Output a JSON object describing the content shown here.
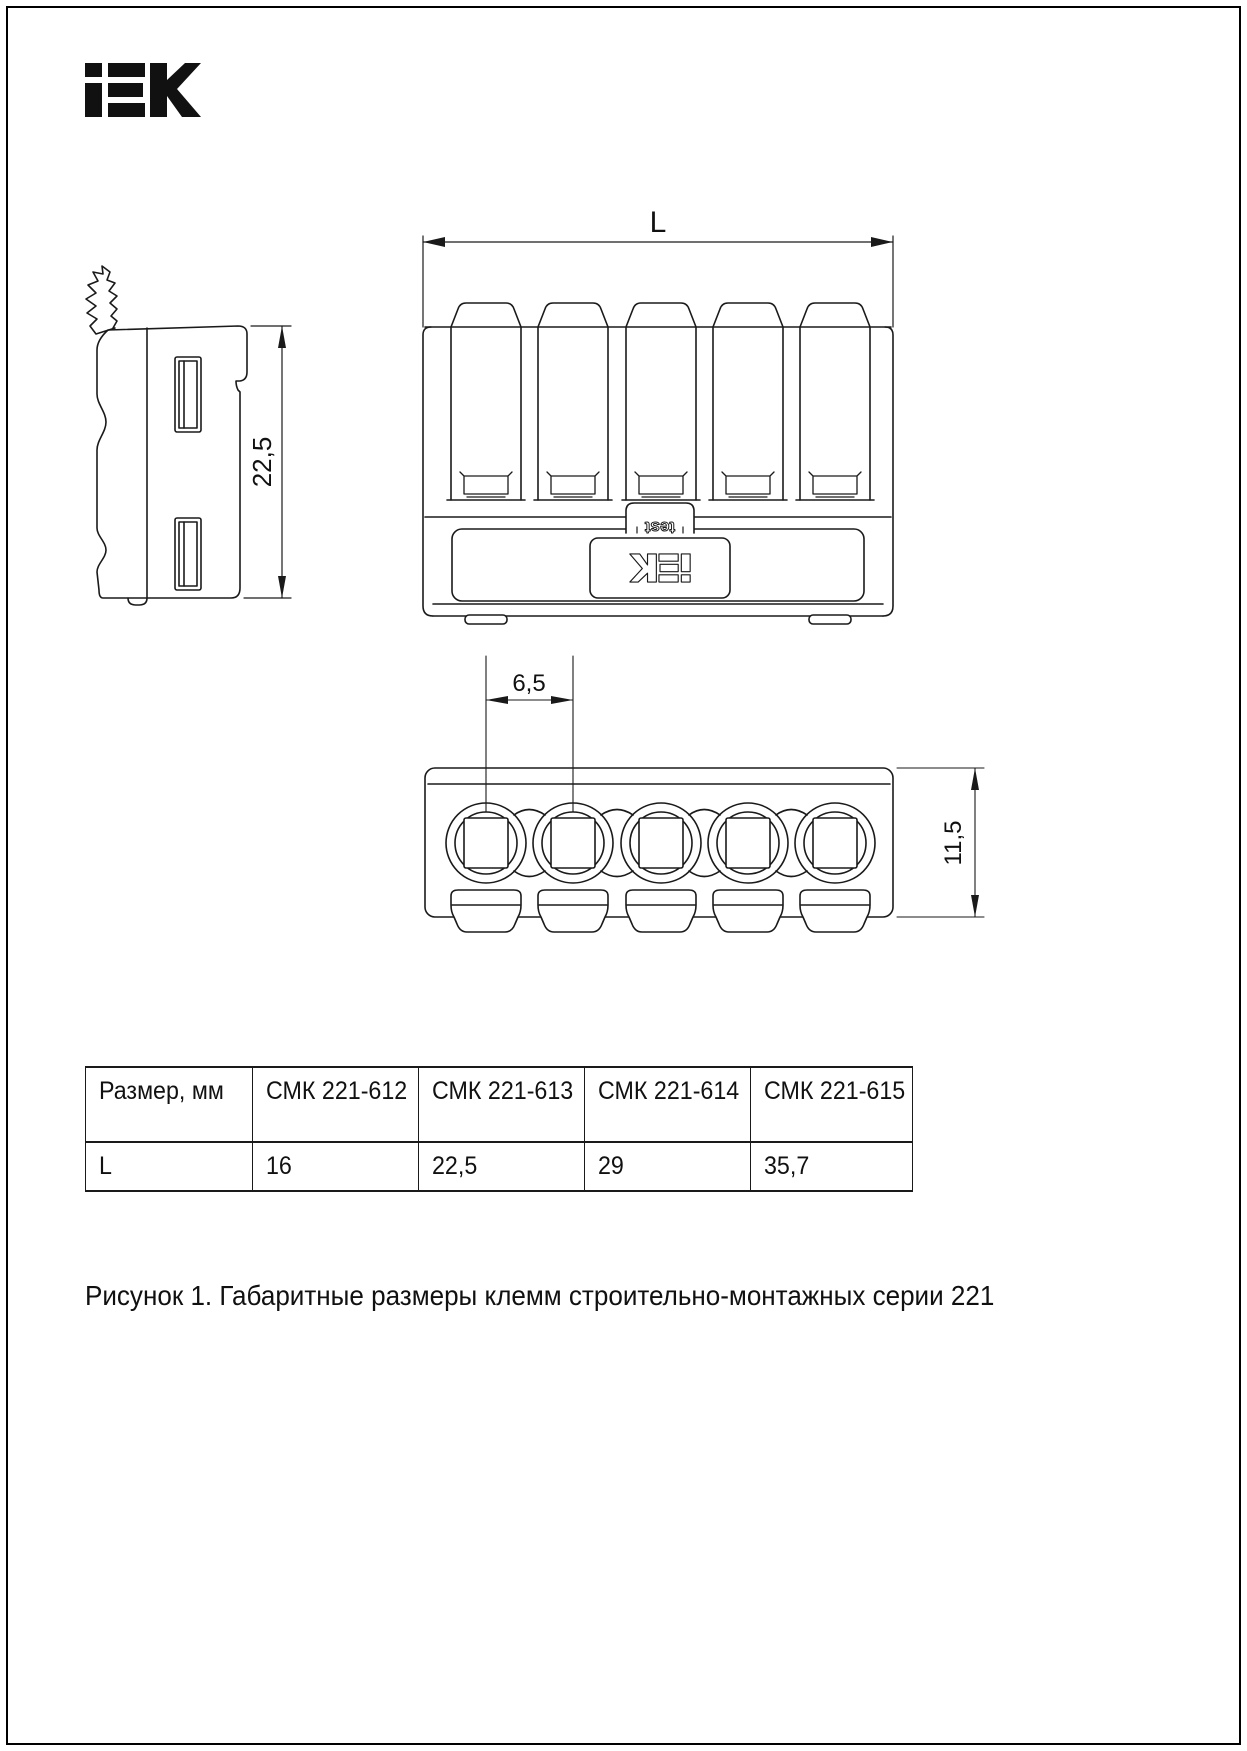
{
  "brand": {
    "name": "iEK"
  },
  "drawing": {
    "test_label": "test",
    "dim_height_side": "22,5",
    "dim_length": "L",
    "dim_pitch": "6,5",
    "dim_height_bottom": "11,5"
  },
  "table": {
    "headers": [
      "Размер, мм",
      "СМК 221-612",
      "СМК 221-613",
      "СМК 221-614",
      "СМК 221-615"
    ],
    "row": [
      "L",
      "16",
      "22,5",
      "29",
      "35,7"
    ]
  },
  "figure": {
    "caption": "Рисунок 1. Габаритные размеры клемм строительно-монтажных серии 221"
  },
  "colors": {
    "line": "#1a1a1a",
    "background": "#ffffff"
  }
}
